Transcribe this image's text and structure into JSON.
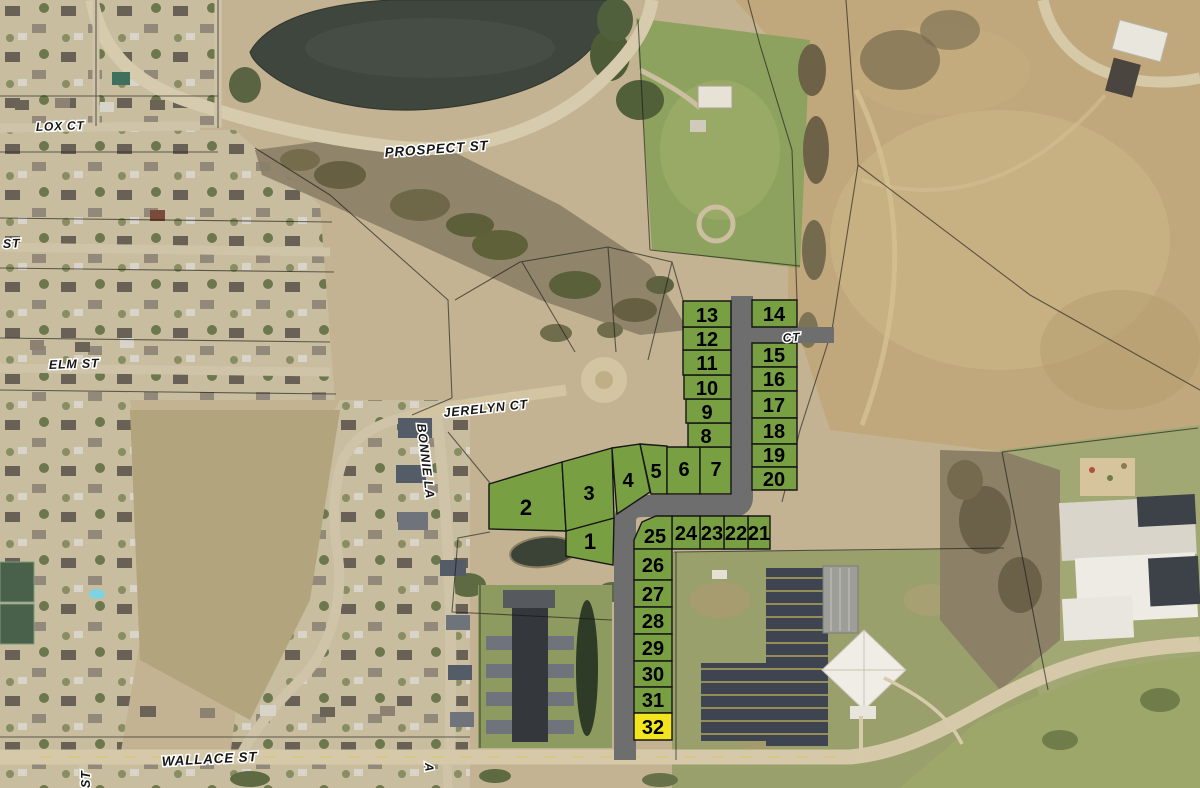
{
  "street_labels": [
    {
      "text": "LOX CT"
    },
    {
      "text": "PROSPECT ST"
    },
    {
      "text": "ST"
    },
    {
      "text": "ELM ST"
    },
    {
      "text": "JERELYN CT"
    },
    {
      "text": "BONNIE LA"
    },
    {
      "text": "CT"
    },
    {
      "text": "WALLACE ST"
    },
    {
      "text": "ST"
    },
    {
      "text": "A"
    }
  ],
  "plat": {
    "lot_numbers": [
      "1",
      "2",
      "3",
      "4",
      "5",
      "6",
      "7",
      "8",
      "9",
      "10",
      "11",
      "12",
      "13",
      "14",
      "15",
      "16",
      "17",
      "18",
      "19",
      "20",
      "21",
      "22",
      "23",
      "24",
      "25",
      "26",
      "27",
      "28",
      "29",
      "30",
      "31",
      "32"
    ],
    "highlighted_lot": "32",
    "colors": {
      "available": "#78A043",
      "highlighted": "#F2E51D",
      "road": "#6E6E6E"
    }
  }
}
